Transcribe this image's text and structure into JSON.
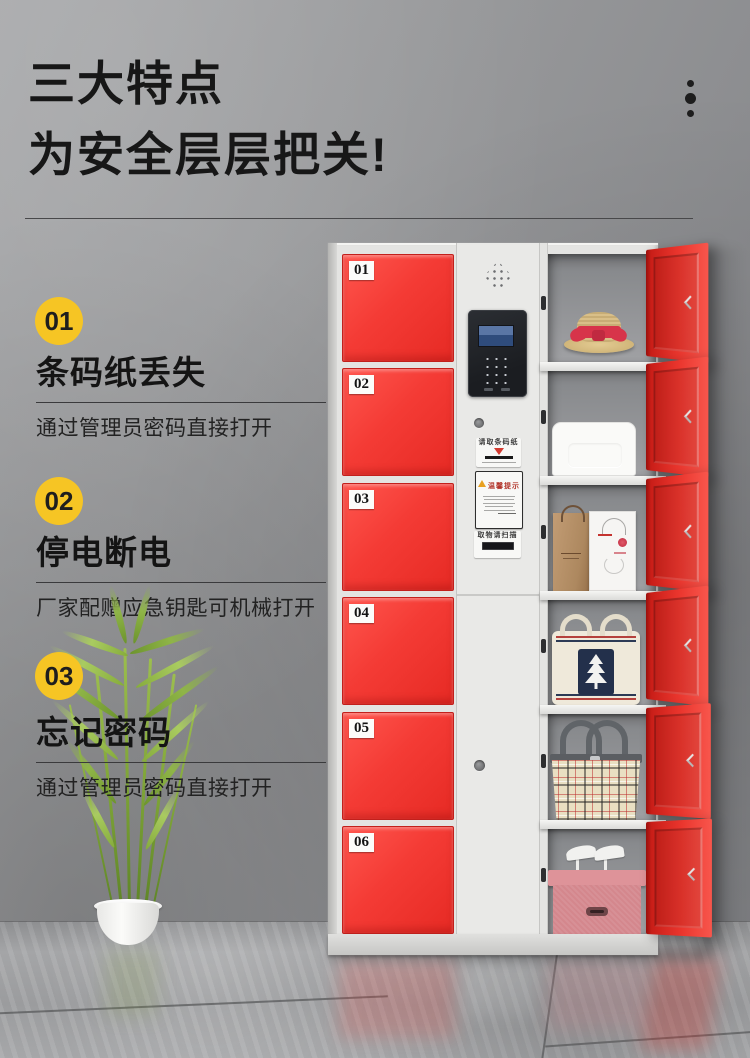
{
  "header": {
    "title_line1": "三大特点",
    "title_line2": "为安全层层把关!"
  },
  "features": [
    {
      "number": "01",
      "title": "条码纸丢失",
      "desc": "通过管理员密码直接打开"
    },
    {
      "number": "02",
      "title": "停电断电",
      "desc": "厂家配赠应急钥匙可机械打开"
    },
    {
      "number": "03",
      "title": "忘记密码",
      "desc": "通过管理员密码直接打开"
    }
  ],
  "locker": {
    "door_numbers": [
      "01",
      "02",
      "03",
      "04",
      "05",
      "06"
    ],
    "panel": {
      "sticker_take_barcode": "请取条码纸",
      "sticker_notice_title": "温馨提示",
      "sticker_scan": "取物请扫描"
    }
  },
  "colors": {
    "door_red": "#F43B35",
    "open_door_red": "#D8231D",
    "accent_yellow": "#F6C524",
    "cabinet_white": "#E4E4E2",
    "wall_gray": "#8E8F91",
    "title_black": "#171717"
  }
}
